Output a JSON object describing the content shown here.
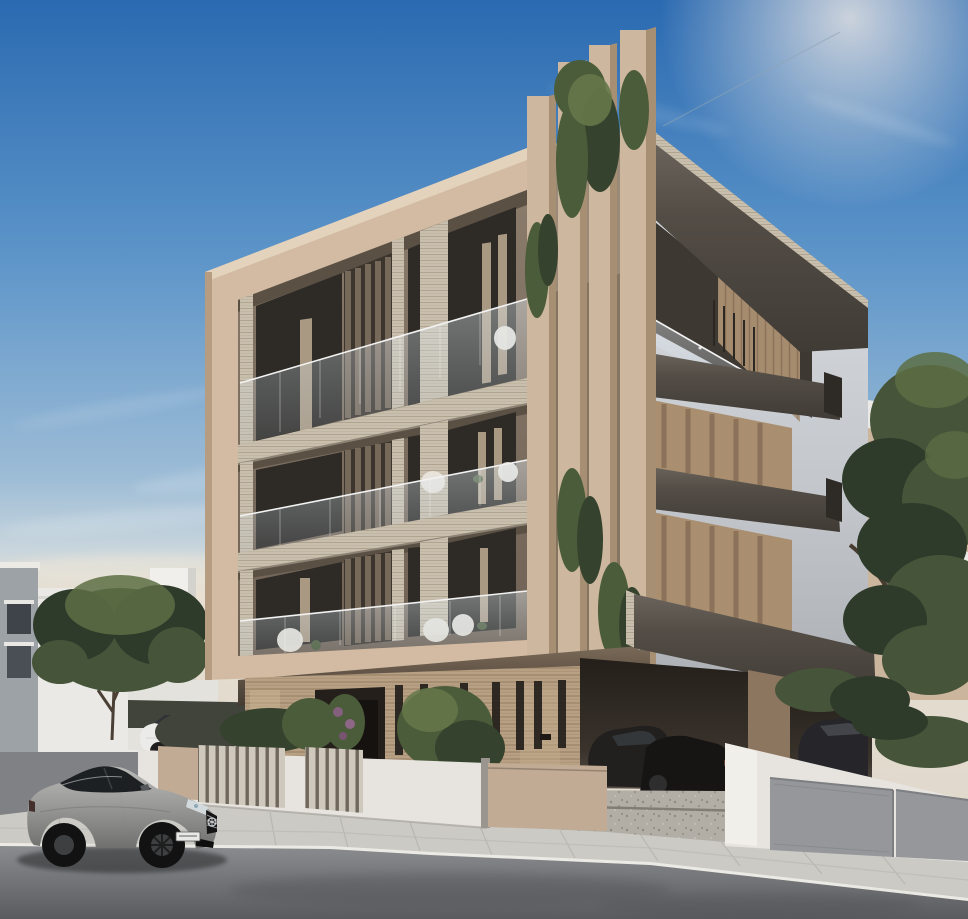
{
  "scene": {
    "type": "architectural-render",
    "description": "Photorealistic rendering of a modern four-storey apartment building in beige, white and travertine stone, with vertical corner fins draped in hanging plants, glass balconies, covered ground-floor parking with cars, a street with sidewalk, fences and gates, neighbouring white buildings, trees, and a silver coupe parked on the road in the foreground under a clear blue sky.",
    "elements": {
      "sky": "clear blue sky with wispy clouds and sun glow",
      "main_building": "four-storey residential building, beige frame facade with recessed glass balconies",
      "corner_fins": "tall vertical corner fins with cascading green plants",
      "se_facade": "light grey side facade with protruding dark balcony slabs and tan louvered niches",
      "ground_floor": "travertine-clad ground floor with entrance slits and covered parking",
      "parked_cars_garage": "dark cars parked under the building",
      "left_buildings": "white and grey neighbouring buildings",
      "right_building": "neighbouring building behind large tree",
      "left_tree": "green tree in front of left neighbouring building",
      "right_tree": "large green tree at right edge",
      "front_fence": "low white rendered wall with timber slat panels and shrubs",
      "pedestrian_gate": "beige pedestrian gate",
      "sliding_gate": "beige sliding driveway gate",
      "grey_gate": "grey double driveway gate on the right",
      "white_parked_car": "white car parked on the side street",
      "silver_coupe": "silver coupe with black wheels parked on the road",
      "license_plate": "unreadable european license plate",
      "road": "asphalt road",
      "sidewalk": "light paved sidewalk with white curb"
    }
  },
  "palette": {
    "sky_top": "#2b6ab1",
    "sky_mid": "#5d95c9",
    "sky_low": "#b8cddd",
    "sky_horizon": "#e9e0d2",
    "cloud_white": "#ffffff",
    "facade_beige": "#d2bba2",
    "facade_beige_dark": "#b69c81",
    "facade_shadow": "#8f7b66",
    "recess_top": "#8a7b6b",
    "recess_bottom": "#6f6255",
    "window_dark": "#2e2b27",
    "curtain": "#c8b59b",
    "fin_brown": "#77695a",
    "fin_gap": "#3c352e",
    "corner_fin": "#cdb79e",
    "corner_fin_side": "#a78f74",
    "travertine_light": "#c9bfae",
    "travertine_line": "#b0a48e",
    "travertine_warm": "#b7a084",
    "travertine_warm_line": "#997f62",
    "slab_dark": "#4f4943",
    "slab_light": "#6b645c",
    "se_wall_top": "#d8dbdf",
    "se_wall_bottom": "#a6aaaf",
    "niche_tan": "#a98f70",
    "wood_slat": "#a58c6f",
    "plant_dark": "#35422d",
    "plant_mid": "#4b5c3a",
    "plant_light": "#66784a",
    "tree_dark": "#2f3b2a",
    "tree_mid": "#46543a",
    "tree_light": "#5d6f44",
    "hedge_dark": "#40443b",
    "road_light": "#8a8c8f",
    "road_dark": "#595b5e",
    "sidewalk": "#cbcac5",
    "curb_white": "#eceae4",
    "gravel": "#b2aea6",
    "white_wall": "#e7e4df",
    "gate_beige": "#c1ab94",
    "gate_grey": "#95979a",
    "gate_grey_dark": "#7c7e81",
    "bg_building_white": "#eae9e5",
    "bg_building_grey": "#9da2a7",
    "bg_building_shade": "#d4d2cd",
    "car_silver": "#a8a8a6",
    "car_silver_dark": "#6f6f6d",
    "car_white": "#ebebe9",
    "car_black": "#161616",
    "chair_white": "#eae6dd",
    "rail_white": "#f2f2f2"
  }
}
